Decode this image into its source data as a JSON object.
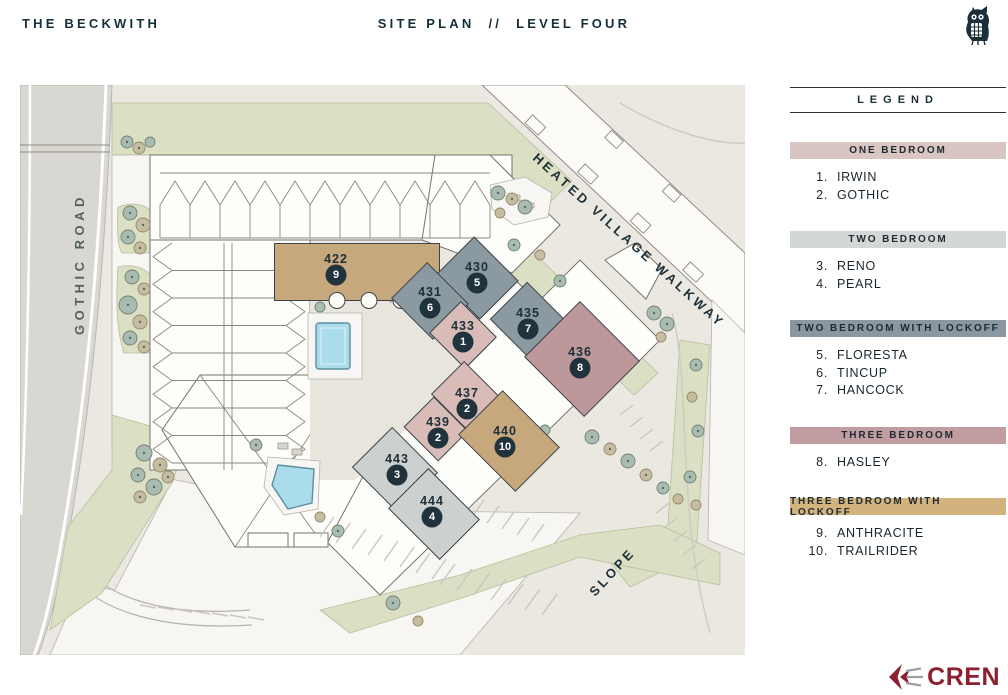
{
  "header": {
    "brand": "THE BECKWITH",
    "title": "SITE PLAN",
    "separator": "//",
    "subtitle": "LEVEL FOUR"
  },
  "map": {
    "road_label": "GOTHIC ROAD",
    "walkway_label": "HEATED VILLAGE WALKWAY",
    "slope_label": "SLOPE",
    "units": [
      {
        "number": "422",
        "legend_index": "9",
        "category": "three_bedroom_lockoff",
        "cx": 316,
        "cy": 181,
        "w": 165,
        "h": 57,
        "rot": 0,
        "sdx": 21,
        "sdy": 6
      },
      {
        "number": "430",
        "legend_index": "5",
        "category": "two_bedroom_lockoff",
        "cx": 457,
        "cy": 189,
        "w": 62,
        "h": 54,
        "rot": 45,
        "sdx": 0,
        "sdy": 4
      },
      {
        "number": "431",
        "legend_index": "6",
        "category": "two_bedroom_lockoff",
        "cx": 410,
        "cy": 214,
        "w": 58,
        "h": 50,
        "rot": 45,
        "sdx": 0,
        "sdy": 2
      },
      {
        "number": "435",
        "legend_index": "7",
        "category": "two_bedroom_lockoff",
        "cx": 508,
        "cy": 235,
        "w": 60,
        "h": 52,
        "rot": 45,
        "sdx": 2,
        "sdy": 2
      },
      {
        "number": "433",
        "legend_index": "1",
        "category": "one_bedroom",
        "cx": 443,
        "cy": 248,
        "w": 50,
        "h": 44,
        "rot": 45,
        "sdx": 0,
        "sdy": 2
      },
      {
        "number": "436",
        "legend_index": "8",
        "category": "three_bedroom",
        "cx": 560,
        "cy": 274,
        "w": 84,
        "h": 78,
        "rot": 45,
        "sdx": 2,
        "sdy": 0
      },
      {
        "number": "437",
        "legend_index": "2",
        "category": "one_bedroom",
        "cx": 447,
        "cy": 315,
        "w": 54,
        "h": 46,
        "rot": 45,
        "sdx": 0,
        "sdy": -3
      },
      {
        "number": "439",
        "legend_index": "2",
        "category": "one_bedroom",
        "cx": 418,
        "cy": 344,
        "w": 48,
        "h": 42,
        "rot": 45,
        "sdx": -2,
        "sdy": 0
      },
      {
        "number": "440",
        "legend_index": "10",
        "category": "three_bedroom_lockoff",
        "cx": 485,
        "cy": 353,
        "w": 80,
        "h": 62,
        "rot": 45,
        "sdx": 4,
        "sdy": 3
      },
      {
        "number": "443",
        "legend_index": "3",
        "category": "two_bedroom",
        "cx": 377,
        "cy": 381,
        "w": 64,
        "h": 56,
        "rot": 45,
        "sdx": -2,
        "sdy": 4
      },
      {
        "number": "444",
        "legend_index": "4",
        "category": "two_bedroom",
        "cx": 412,
        "cy": 423,
        "w": 72,
        "h": 56,
        "rot": 45,
        "sdx": 2,
        "sdy": 6
      }
    ]
  },
  "legend": {
    "title": "LEGEND",
    "sections": [
      {
        "key": "one_bedroom",
        "label": "ONE BEDROOM",
        "items": [
          {
            "num": "1.",
            "name": "IRWIN"
          },
          {
            "num": "2.",
            "name": "GOTHIC"
          }
        ]
      },
      {
        "key": "two_bedroom",
        "label": "TWO BEDROOM",
        "items": [
          {
            "num": "3.",
            "name": "RENO"
          },
          {
            "num": "4.",
            "name": "PEARL"
          }
        ]
      },
      {
        "key": "two_bedroom_lockoff",
        "label": "TWO BEDROOM WITH LOCKOFF",
        "items": [
          {
            "num": "5.",
            "name": "FLORESTA"
          },
          {
            "num": "6.",
            "name": "TINCUP"
          },
          {
            "num": "7.",
            "name": "HANCOCK"
          }
        ]
      },
      {
        "key": "three_bedroom",
        "label": "THREE BEDROOM",
        "items": [
          {
            "num": "8.",
            "name": "HASLEY"
          }
        ]
      },
      {
        "key": "three_bedroom_lockoff",
        "label": "THREE BEDROOM WITH LOCKOFF",
        "items": [
          {
            "num": "9.",
            "name": "ANTHRACITE"
          },
          {
            "num": "10.",
            "name": "TRAILRIDER"
          }
        ]
      }
    ]
  },
  "footer": {
    "logo_text": "CREN"
  },
  "colors": {
    "one_bedroom": "#d9bcb8",
    "two_bedroom": "#ccd1cf",
    "two_bedroom_lockoff": "#8b99a1",
    "three_bedroom": "#bd989b",
    "three_bedroom_lockoff": "#c7a87c",
    "band_one_bedroom": "#d9c5c1",
    "band_two_bedroom": "#d3d7d6",
    "band_two_bedroom_lockoff": "#8a97a0",
    "band_three_bedroom": "#c19da1",
    "band_three_bedroom_lockoff": "#d2b37e",
    "accent_navy": "#1d2f38",
    "cren_red": "#8e1f2f"
  }
}
